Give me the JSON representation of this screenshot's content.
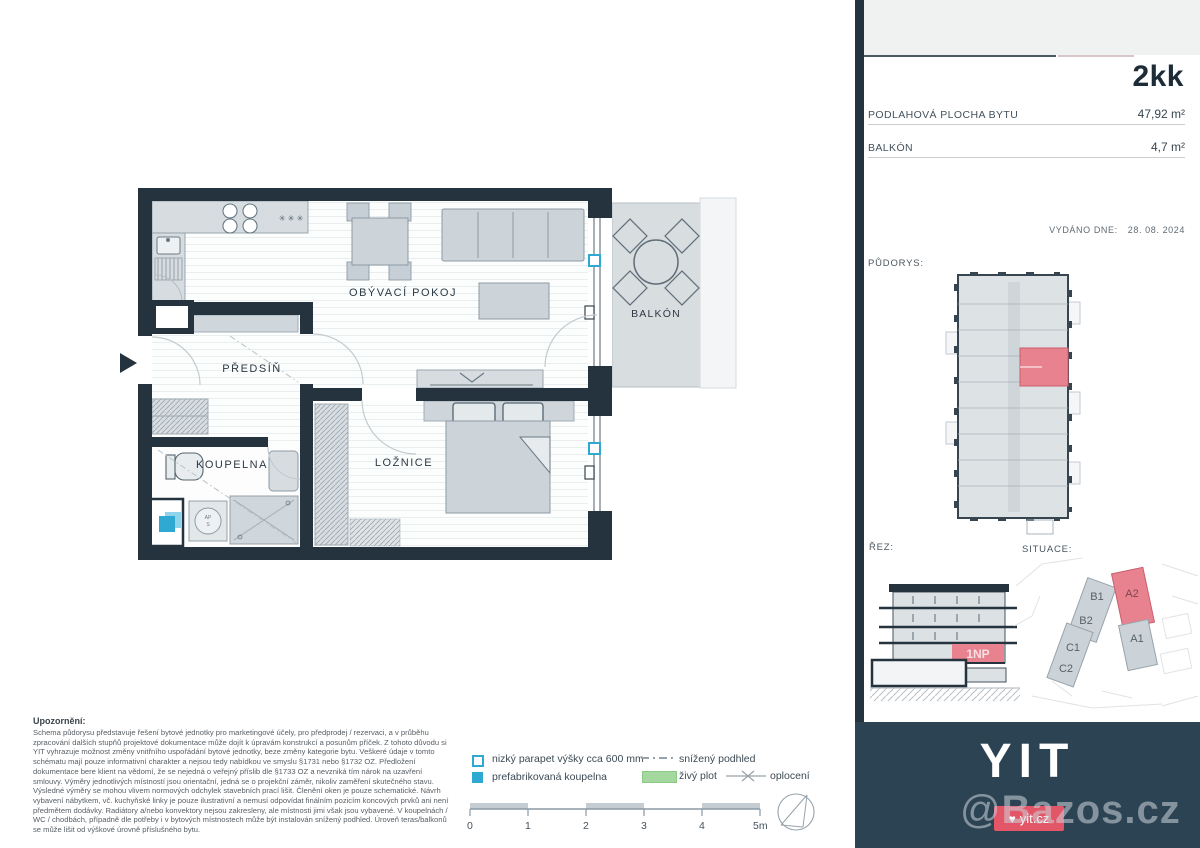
{
  "panel": {
    "unit_type": "2kk",
    "area_label": "PODLAHOVÁ PLOCHA BYTU",
    "area_value": "47,92 m²",
    "balcony_label": "BALKÓN",
    "balcony_value": "4,7 m²",
    "issued_label": "VYDÁNO DNE:",
    "issued_date": "28. 08. 2024",
    "pudorys_label": "PŮDORYS:",
    "rez_label": "ŘEZ:",
    "situace_label": "SITUACE:",
    "floor_tag": "1NP",
    "buildings": {
      "b1": "B1",
      "b2": "B2",
      "a2": "A2",
      "a1": "A1",
      "c1": "C1",
      "c2": "C2"
    }
  },
  "footer": {
    "brand": "YIT",
    "site": "yit.cz",
    "watermark_symbol": "@",
    "watermark": "Bazos.cz"
  },
  "floorplan": {
    "living": "OBÝVACÍ POKOJ",
    "hall": "PŘEDSÍŇ",
    "bathroom": "KOUPELNA",
    "bedroom": "LOŽNICE",
    "balcony": "BALKÓN",
    "washer_line1": "AP",
    "washer_line2": "S",
    "fridge_symbol": "✳ ✳ ✳"
  },
  "disclaimer": {
    "title": "Upozornění:",
    "body": "Schema půdorysu představuje řešení bytové jednotky pro marketingové účely, pro předprodej / rezervaci, a v průběhu zpracování dalších stupňů projektové dokumentace může dojít k úpravám konstrukcí a posunům příček. Z tohoto důvodu si YIT vyhrazuje možnost změny vnitřního uspořádání bytové jednotky, beze změny kategorie bytu. Veškeré údaje v tomto schématu mají pouze informativní charakter a nejsou tedy nabídkou ve smyslu §1731 nebo §1732 OZ. Předložení dokumentace bere klient na vědomí, že se nejedná o veřejný příslib dle §1733 OZ a nevzniká tím nárok na uzavření smlouvy. Výměry jednotlivých místností jsou orientační, jedná se o projekční záměr, nikoliv zaměření skutečného stavu. Výsledné výměry se mohou vlivem normových odchylek stavebních prací lišit. Členění oken je pouze schematické. Návrh vybavení nábytkem, vč. kuchyňské linky je pouze ilustrativní a nemusí odpovídat finálním pozicím koncových prvků ani není předmětem dodávky. Radiátory a/nebo konvektory nejsou zakresleny, ale místnosti jimi však jsou vybavené. V koupelnách / WC / chodbách, případně dle potřeby i v bytových místnostech může být instalován snížený podhled. Úroveň teras/balkonů se může lišit od výškové úrovně příslušného bytu."
  },
  "legend": {
    "low_sill": "nizký parapet výšky cca 600 mm",
    "lowered_ceiling": "snížený podhled",
    "prefab_bath": "prefabrikovaná koupelna",
    "hedge": "živý plot",
    "fence": "oplocení"
  },
  "scalebar": {
    "t0": "0",
    "t1": "1",
    "t2": "2",
    "t3": "3",
    "t4": "4",
    "t5": "5m"
  },
  "colors": {
    "wall": "#24333e",
    "accent_red": "#e8828f",
    "cyan": "#2fa9d2",
    "footer_teal": "#2c4353",
    "hedge_green": "#a5d89e",
    "badge_red": "#e25668"
  }
}
